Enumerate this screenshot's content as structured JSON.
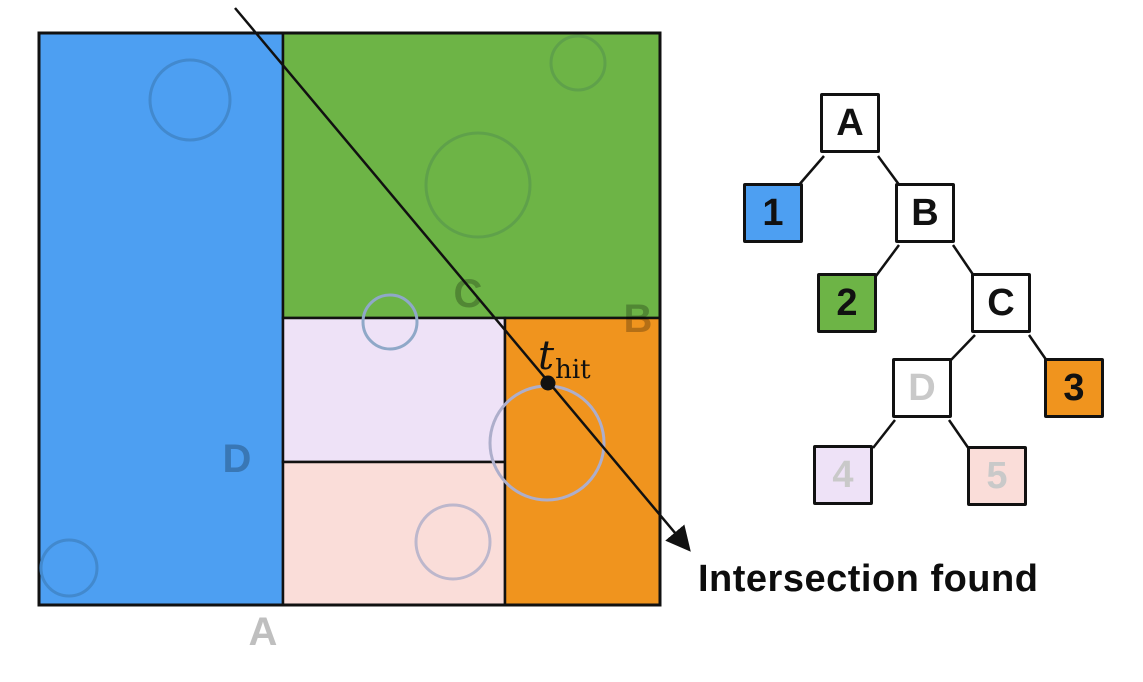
{
  "figure": {
    "caption": "Intersection found",
    "hit_point_label": {
      "symbol": "t",
      "subscript": "hit"
    }
  },
  "spatial_diagram": {
    "region_labels": {
      "A": "A",
      "B": "B",
      "C": "C",
      "D": "D"
    }
  },
  "tree_diagram": {
    "nodes": [
      {
        "label": "A",
        "kind": "internal"
      },
      {
        "label": "1",
        "kind": "leaf",
        "color": "blue"
      },
      {
        "label": "B",
        "kind": "internal"
      },
      {
        "label": "2",
        "kind": "leaf",
        "color": "green"
      },
      {
        "label": "C",
        "kind": "internal"
      },
      {
        "label": "D",
        "kind": "internal-faded"
      },
      {
        "label": "3",
        "kind": "leaf",
        "color": "orange"
      },
      {
        "label": "4",
        "kind": "leaf-faded",
        "color": "lavender"
      },
      {
        "label": "5",
        "kind": "leaf-faded",
        "color": "pink"
      }
    ]
  },
  "colors": {
    "blue": "#4D9FF2",
    "green": "#6DB446",
    "orange": "#F0941E",
    "lavender": "#EEE2F7",
    "pink": "#FADDD9",
    "white": "#FFFFFF",
    "faded_text": "#C9C9C9",
    "region_label": "rgba(0,0,0,0.25)",
    "line": "#111111"
  }
}
